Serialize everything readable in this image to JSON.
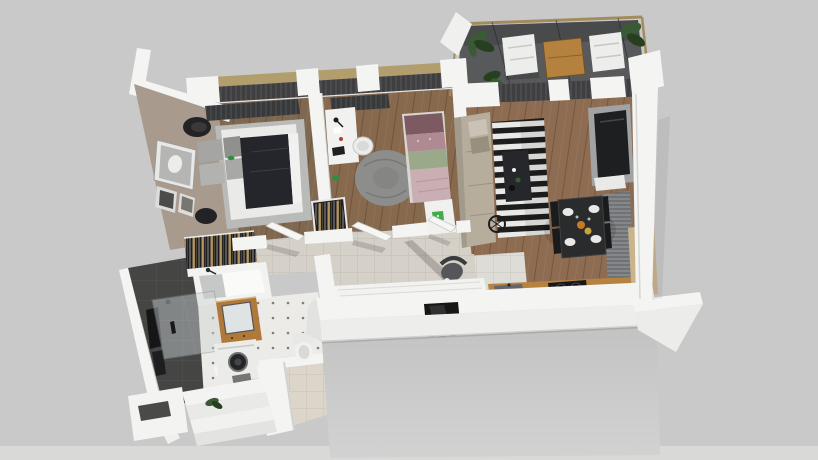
{
  "scene": {
    "type": "3d-floor-plan-render",
    "view": "isometric top-down cutaway of an apartment",
    "rooms": [
      {
        "name": "master-bedroom",
        "objects": [
          "radiator",
          "armchair",
          "area-rug",
          "double-bed",
          "pillows",
          "dark-blanket",
          "nightstand-stool",
          "wall-art",
          "wardrobe-rack",
          "parrot-figurine"
        ]
      },
      {
        "name": "kids-bedroom",
        "objects": [
          "radiator",
          "desk",
          "desk-lamp",
          "round-pouf",
          "round-fluffy-rug",
          "single-bed",
          "foot-table",
          "green-book",
          "wardrobe-rack",
          "parrot-figurine"
        ]
      },
      {
        "name": "living-room",
        "objects": [
          "corner-sofa",
          "striped-rug",
          "coffee-table",
          "tv-unit",
          "tv",
          "radiator",
          "floor-fan"
        ]
      },
      {
        "name": "dining-area",
        "objects": [
          "dining-table",
          "dining-chairs",
          "plates",
          "food-dishes"
        ]
      },
      {
        "name": "kitchen",
        "objects": [
          "wood-counter",
          "sink",
          "cooktop",
          "white-island",
          "tall-wood-cabinet",
          "lounge-chair"
        ]
      },
      {
        "name": "hallway",
        "objects": [
          "tile-floor",
          "open-doors"
        ]
      },
      {
        "name": "bathroom",
        "objects": [
          "dark-tile-wall",
          "towels",
          "bathtub",
          "glass-shower",
          "wood-vanity",
          "mirror",
          "washing-machine",
          "toilet",
          "dotted-floor",
          "bath-mat"
        ]
      },
      {
        "name": "entrance",
        "objects": [
          "steps",
          "plant",
          "niche-wall"
        ]
      },
      {
        "name": "balcony",
        "objects": [
          "lounge-chair",
          "lounge-chair",
          "outdoor-table",
          "plants",
          "metal-frame"
        ]
      }
    ]
  },
  "palette": {
    "bg": "#c8c9c8",
    "bg_bottom": "#d9dad8",
    "wall_white": "#f4f4f2",
    "wall_face": "#ededeb",
    "wall_shadow": "#cfcfcd",
    "taupe_wall": "#a89a8d",
    "charcoal_wall": "#454544",
    "wood_floor_master": "#7f684f",
    "wood_floor_kids": "#87694e",
    "wood_floor_living": "#8d6c52",
    "hall_tile": "#d6d1c8",
    "kitchen_tile": "#dedcd6",
    "entry_tile": "#dcd6ca",
    "bath_floor": "#edebe7",
    "rug_gray": "#b9bbb9",
    "round_rug": "#8d8d8b",
    "bed_blanket": "#24262b",
    "linen": "#eaeae8",
    "pillow_gray": "#a5a5a3",
    "sofa_beige": "#b6ad9d",
    "stripe_dark": "#1e1e1e",
    "stripe_light": "#e9e9e7",
    "table_dark": "#2a2b2d",
    "chair_black": "#1a1b1d",
    "tv_black": "#1e1f21",
    "tv_unit_gray": "#a0a2a4",
    "radiator_dark": "#38393b",
    "radiator_gray": "#85878a",
    "window_dark": "#3f3f41",
    "blind_tan": "#b29d6c",
    "balcony_floor": "#57595b",
    "frame_tan": "#a28c5e",
    "plant_green": "#3a5a36",
    "plant_dark": "#26401f",
    "outdoor_wood": "#b5813e",
    "counter_wood": "#b5823f",
    "vanity_wood": "#b0793a",
    "cabinet_wood_light": "#c9b48c",
    "appliance_white": "#ebebe9",
    "glass": "#ccd4d4",
    "opening_black": "#161616",
    "clothes_dark": "#1e1e22",
    "clothes_gold": "#c2a264",
    "bed2_mauve": "#7d5a62",
    "bed2_pink": "#b08a92",
    "bed2_green": "#9aa98a",
    "bed2_blanket": "#c9aeb4",
    "food_orange": "#cc7722",
    "food_yellow": "#c8a43c",
    "book_green": "#3fae49"
  }
}
